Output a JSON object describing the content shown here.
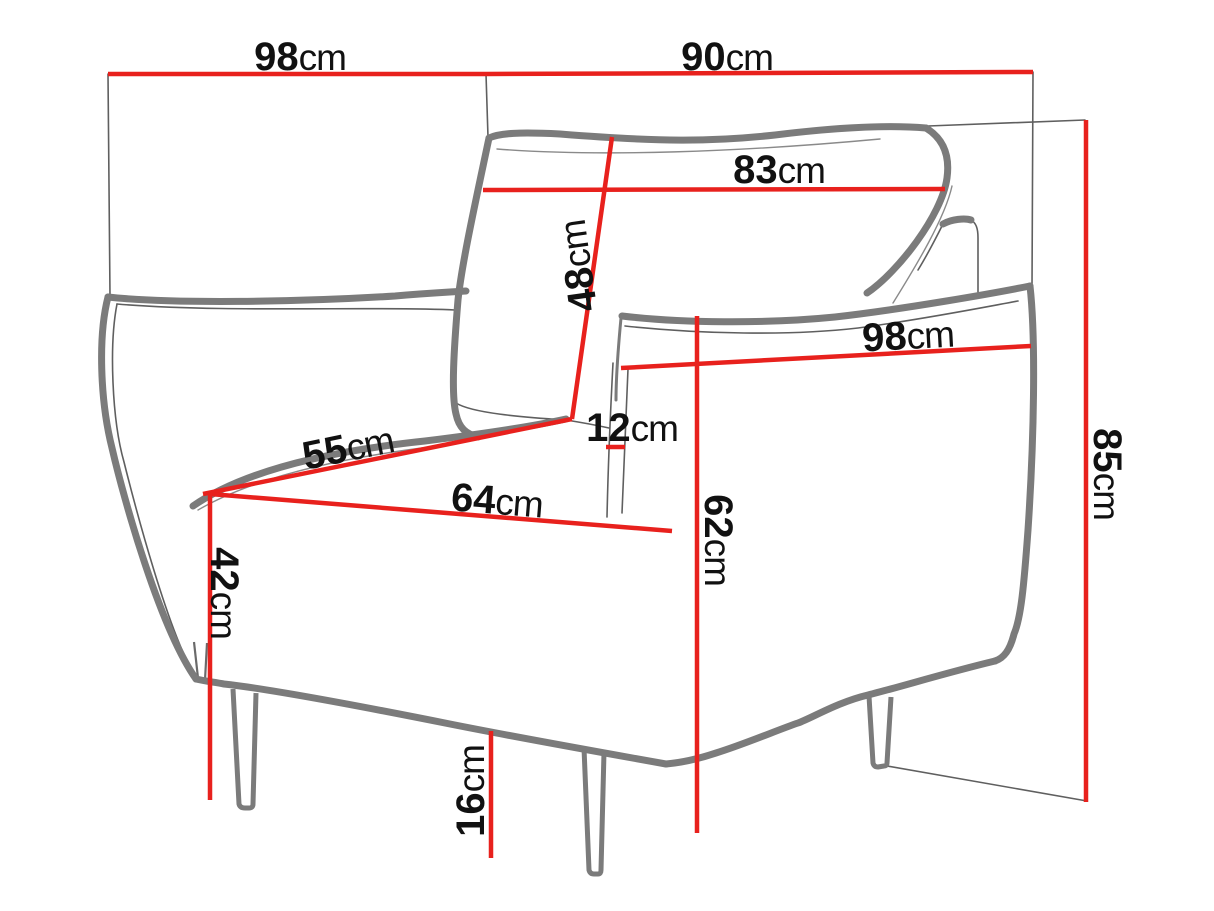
{
  "diagram": {
    "type": "furniture-dimension-diagram",
    "subject": "armchair line drawing with red dimension lines",
    "unit": "cm",
    "labels": {
      "back_width": {
        "value": "98",
        "unit": "cm"
      },
      "side_depth_top": {
        "value": "90",
        "unit": "cm"
      },
      "backrest_width": {
        "value": "83",
        "unit": "cm"
      },
      "backrest_height": {
        "value": "48",
        "unit": "cm"
      },
      "arm_length": {
        "value": "98",
        "unit": "cm"
      },
      "back_gap": {
        "value": "12",
        "unit": "cm"
      },
      "seat_side": {
        "value": "55",
        "unit": "cm"
      },
      "seat_width": {
        "value": "64",
        "unit": "cm"
      },
      "arm_height": {
        "value": "62",
        "unit": "cm"
      },
      "seat_height": {
        "value": "42",
        "unit": "cm"
      },
      "total_height": {
        "value": "85",
        "unit": "cm"
      },
      "leg_height": {
        "value": "16",
        "unit": "cm"
      }
    },
    "colors": {
      "dimension_line": "#e8211d",
      "outline_thick": "#7b7b7b",
      "outline_thin": "#5f5f5f",
      "label_text": "#111111",
      "background": "#ffffff"
    }
  }
}
